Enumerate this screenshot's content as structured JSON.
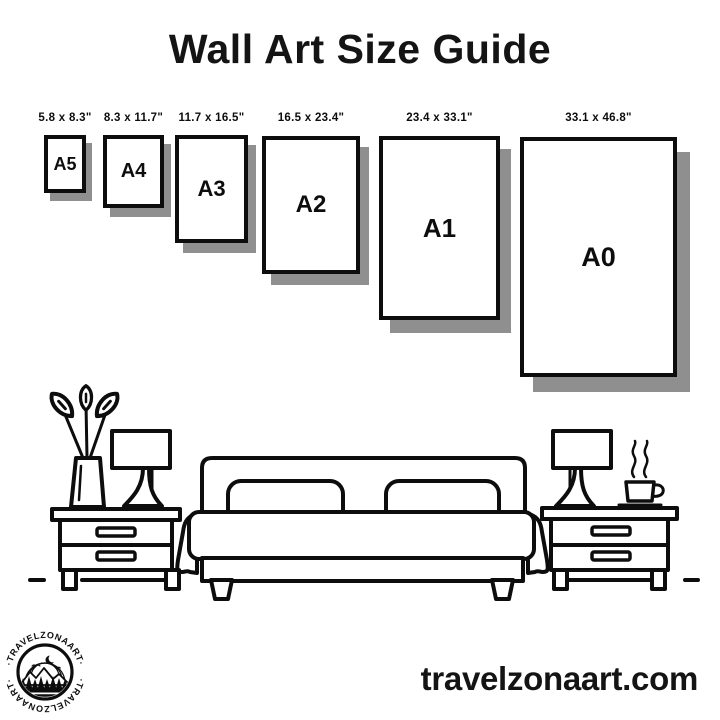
{
  "colors": {
    "background": "#ffffff",
    "line": "#0d0d0d",
    "frame_shadow": "#8f8f8f"
  },
  "header": {
    "title": "Wall Art Size Guide"
  },
  "size_guide": {
    "frames": [
      {
        "label": "A5",
        "dimensions": "5.8 x 8.3\""
      },
      {
        "label": "A4",
        "dimensions": "8.3 x 11.7\""
      },
      {
        "label": "A3",
        "dimensions": "11.7 x 16.5\""
      },
      {
        "label": "A2",
        "dimensions": "16.5 x 23.4\""
      },
      {
        "label": "A1",
        "dimensions": "23.4 x 33.1\""
      },
      {
        "label": "A0",
        "dimensions": "33.1 x 46.8\""
      }
    ]
  },
  "illustration": {
    "scene": "bedroom line art",
    "items": [
      "plant-vase",
      "table-lamp-left",
      "nightstand-left",
      "bed-with-pillows",
      "nightstand-right",
      "table-lamp-right",
      "coffee-cup-with-steam",
      "floor-line"
    ]
  },
  "branding": {
    "logo_text": "·TRAVELZONAART·",
    "website": "travelzonaart.com"
  }
}
